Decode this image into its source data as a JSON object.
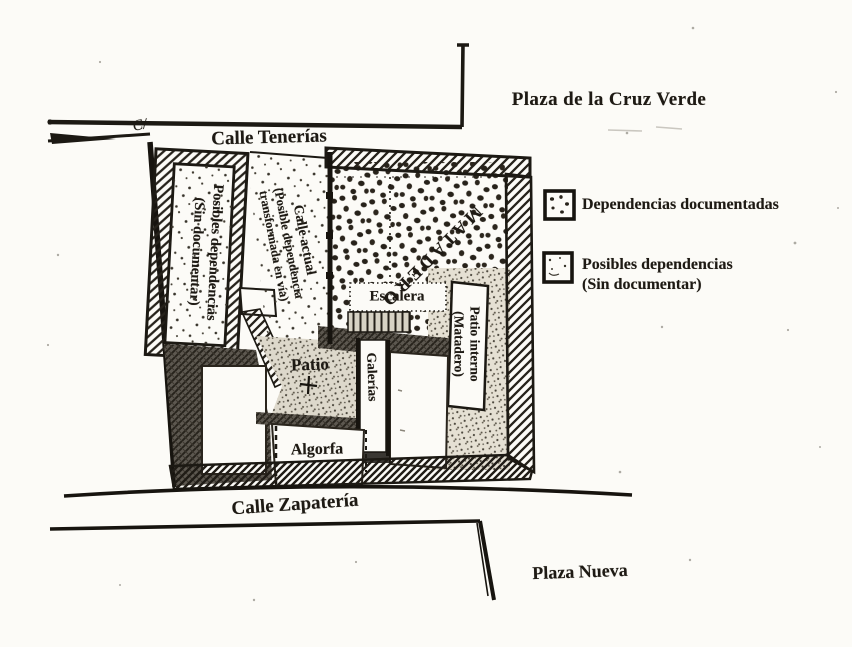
{
  "map": {
    "streets": {
      "plaza_cruz_verde": "Plaza de la Cruz Verde",
      "calle_tenerias": "Calle Tenerías",
      "calle_zapateria": "Calle Zapatería",
      "plaza_nueva": "Plaza Nueva",
      "street_prefix": "C/"
    },
    "rooms": {
      "posibles_line1": "Posibles dependencias",
      "posibles_line2": "(Sin documentar)",
      "calle_actual_line1": "Calle actual",
      "calle_actual_line2": "(Posible dependencia",
      "calle_actual_line3": "transformada en vía)",
      "matadero": "MATADERO",
      "escalera": "Escalera",
      "patio": "Patio",
      "galerias": "Galerías",
      "algorfa": "Algorfa",
      "patio_interno_line1": "Patio interno",
      "patio_interno_line2": "(Matadero)"
    }
  },
  "legend": {
    "documented_label": "Dependencias documentadas",
    "possible_line1": "Posibles dependencias",
    "possible_line2": "(Sin documentar)"
  },
  "colors": {
    "paper": "#fcfbf7",
    "ink": "#1c1913"
  }
}
